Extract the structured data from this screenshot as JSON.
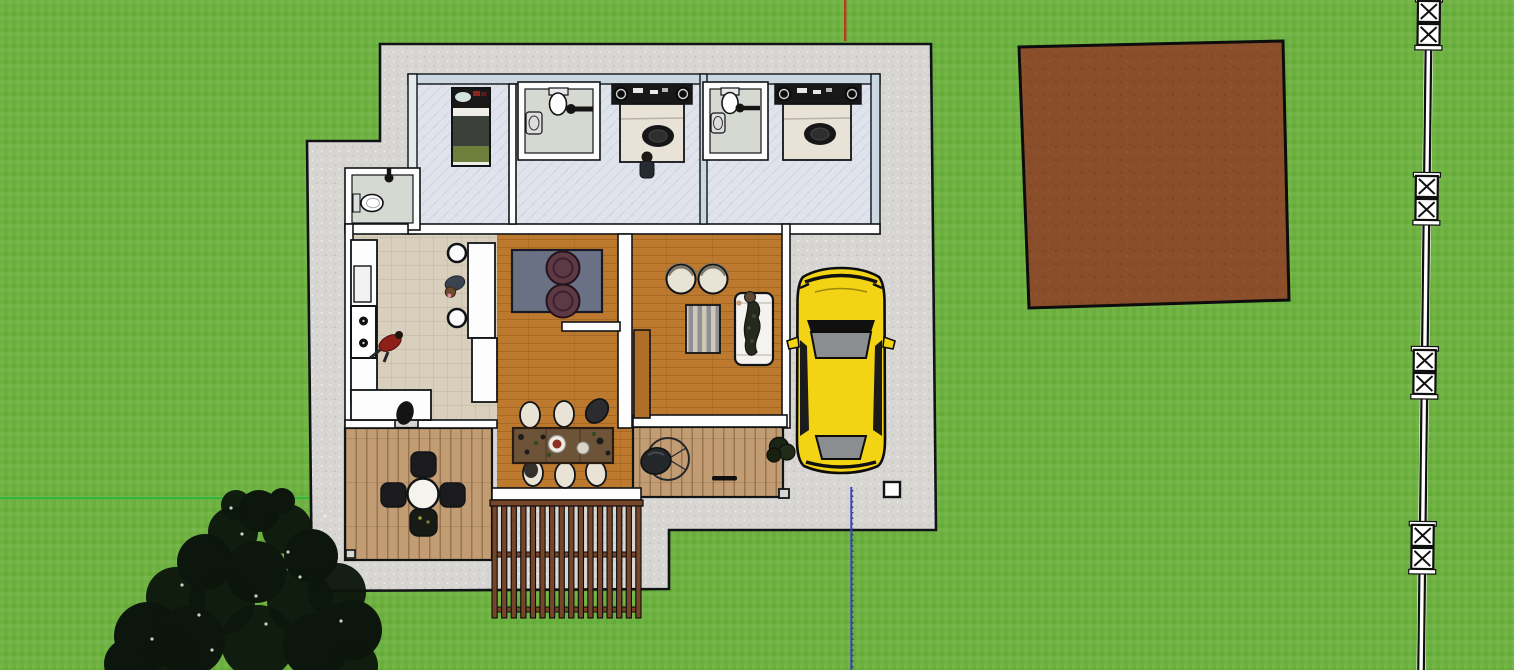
{
  "scene": {
    "label": "top-down 3d viewport of a single-story house model on a grass lot with driveway, yellow car, dirt patch, fence line and tree",
    "canvas": {
      "width": 1514,
      "height": 670
    },
    "colors": {
      "grass": "#6cb13f",
      "grass_light": "#7abb4e",
      "grass_dark": "#61a636",
      "pad": "#d7d6d3",
      "pad_speckle": "#c8c7c3",
      "outline": "#111417",
      "wall_white": "#fdfdfd",
      "wall_blue": "#ccd8e1",
      "wall_blue_light": "#e4eaee",
      "tile": "#e0e3ec",
      "tile_line": "#c3c9d8",
      "kitchen_tile": "#d8cfbd",
      "kitchen_line": "#bfae93",
      "wood": "#bd7a2e",
      "wood_line": "#9c6220",
      "deck": "#c29c72",
      "deck_line": "#8a6847",
      "pergola_wood": "#77462a",
      "dirt": "#8b4e2b",
      "dirt_dark": "#7a4020",
      "dirt_light": "#99582f",
      "car_yellow": "#f3d414",
      "glass": "#8b8e90",
      "rug": "#6a7184",
      "rug_stripe_a": "#cfc8b8",
      "rug_stripe_b": "#8f9094",
      "pouf": "#5d3944",
      "sofa": "#f5f3ef",
      "chair_beige": "#e9e3d6",
      "table_wood": "#6d5338",
      "tree": "#0d160c",
      "bathroom_floor": "#d6d9d1",
      "bed_green": "#6e7f3c",
      "bed_dark": "#3b403a",
      "bed_beige": "#e9e2d6",
      "headboard": "#181818",
      "axis_red": "#bb3a20",
      "axis_green": "#35b43a",
      "axis_blue": "#3a43c4"
    },
    "axes": {
      "red_segment": {
        "x": 844,
        "y1": 0,
        "y2": 41
      },
      "green_segment": {
        "y": 497,
        "x1": 0,
        "x2": 310
      },
      "blue_segment": {
        "x": 850,
        "y1": 487,
        "y2": 670
      }
    },
    "fence": {
      "rail_x": 1429,
      "angle_deg": 0.68,
      "post_pairs_y": [
        0,
        175,
        349,
        524
      ],
      "post_size": 22
    },
    "pergola": {
      "x": 492,
      "y": 500,
      "width": 149,
      "height": 118,
      "slat_count": 16,
      "slat_width": 5.2,
      "rail_ys": [
        552,
        607
      ]
    },
    "tree": {
      "blobs": [
        [
          148,
          636,
          34
        ],
        [
          176,
          597,
          30
        ],
        [
          205,
          562,
          28
        ],
        [
          233,
          532,
          25
        ],
        [
          259,
          511,
          21
        ],
        [
          287,
          529,
          25
        ],
        [
          311,
          556,
          27
        ],
        [
          337,
          592,
          29
        ],
        [
          352,
          630,
          30
        ],
        [
          300,
          601,
          33
        ],
        [
          256,
          572,
          31
        ],
        [
          222,
          602,
          33
        ],
        [
          190,
          641,
          35
        ],
        [
          258,
          642,
          37
        ],
        [
          316,
          646,
          33
        ],
        [
          352,
          666,
          26
        ],
        [
          130,
          664,
          26
        ],
        [
          236,
          505,
          15
        ],
        [
          282,
          501,
          13
        ],
        [
          171,
          655,
          30
        ]
      ],
      "specks": [
        [
          325,
          516
        ],
        [
          242,
          534
        ],
        [
          182,
          585
        ],
        [
          300,
          577
        ],
        [
          266,
          624
        ],
        [
          212,
          650
        ],
        [
          341,
          621
        ],
        [
          152,
          639
        ],
        [
          231,
          508
        ],
        [
          288,
          552
        ],
        [
          256,
          596
        ],
        [
          199,
          615
        ]
      ]
    },
    "objects": [
      "grass-lot",
      "concrete-pad",
      "house",
      "single-bedroom",
      "bathroom-a",
      "bathroom-b",
      "hall-bathroom",
      "bedroom-a",
      "bedroom-b",
      "kitchen",
      "kitchen-island",
      "living-room",
      "tv-room",
      "dining-set",
      "outdoor-deck-left",
      "outdoor-deck-right",
      "patio-set",
      "pergola",
      "yellow-car",
      "dirt-patch",
      "fence-line",
      "tree",
      "utility-box",
      "axis-lines"
    ]
  }
}
